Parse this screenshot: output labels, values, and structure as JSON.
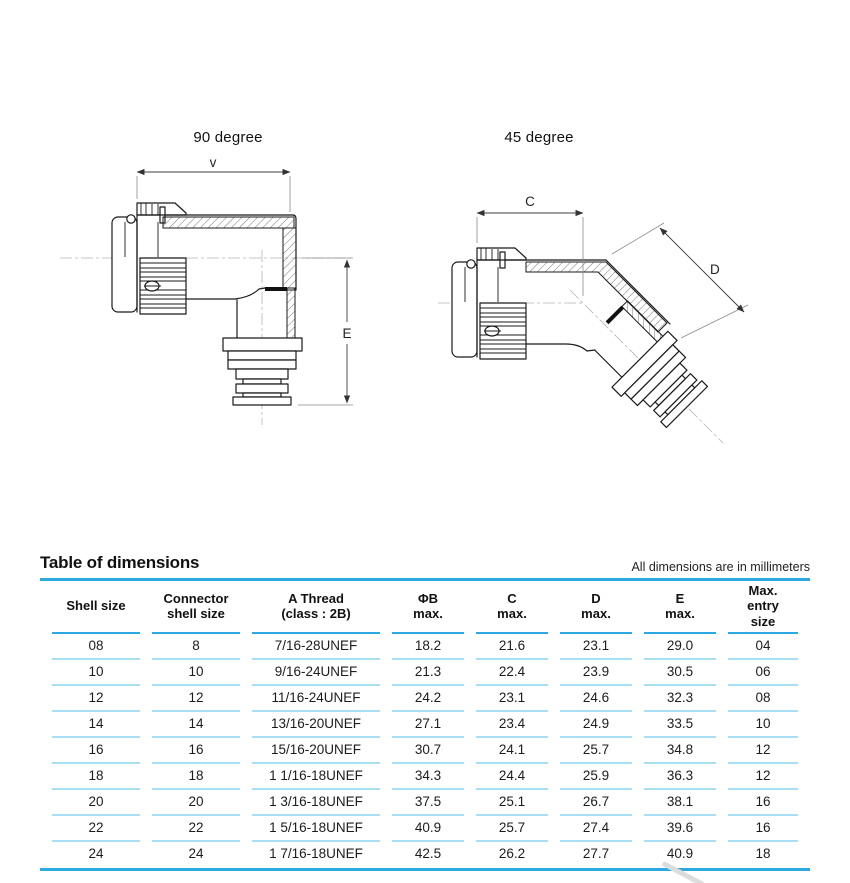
{
  "drawings": {
    "d90": {
      "title": "90 degree",
      "dim_top_label": "v",
      "dim_side_label": "E"
    },
    "d45": {
      "title": "45 degree",
      "dim_top_label": "C",
      "dim_diag_label": "D"
    }
  },
  "table": {
    "title": "Table of dimensions",
    "note": "All dimensions are in millimeters",
    "columns": [
      {
        "lines": [
          "Shell size"
        ]
      },
      {
        "lines": [
          "Connector",
          "shell size"
        ]
      },
      {
        "lines": [
          "A Thread",
          "(class : 2B)"
        ]
      },
      {
        "lines": [
          "ΦB",
          "max."
        ]
      },
      {
        "lines": [
          "C",
          "max."
        ]
      },
      {
        "lines": [
          "D",
          "max."
        ]
      },
      {
        "lines": [
          "E",
          "max."
        ]
      },
      {
        "lines": [
          "Max.",
          "entry",
          "size"
        ]
      }
    ],
    "rows": [
      [
        "08",
        "8",
        "7/16-28UNEF",
        "18.2",
        "21.6",
        "23.1",
        "29.0",
        "04"
      ],
      [
        "10",
        "10",
        "9/16-24UNEF",
        "21.3",
        "22.4",
        "23.9",
        "30.5",
        "06"
      ],
      [
        "12",
        "12",
        "11/16-24UNEF",
        "24.2",
        "23.1",
        "24.6",
        "32.3",
        "08"
      ],
      [
        "14",
        "14",
        "13/16-20UNEF",
        "27.1",
        "23.4",
        "24.9",
        "33.5",
        "10"
      ],
      [
        "16",
        "16",
        "15/16-20UNEF",
        "30.7",
        "24.1",
        "25.7",
        "34.8",
        "12"
      ],
      [
        "18",
        "18",
        "1 1/16-18UNEF",
        "34.3",
        "24.4",
        "25.9",
        "36.3",
        "12"
      ],
      [
        "20",
        "20",
        "1 3/16-18UNEF",
        "37.5",
        "25.1",
        "26.7",
        "38.1",
        "16"
      ],
      [
        "22",
        "22",
        "1 5/16-18UNEF",
        "40.9",
        "25.7",
        "27.4",
        "39.6",
        "16"
      ],
      [
        "24",
        "24",
        "1 7/16-18UNEF",
        "42.5",
        "26.2",
        "27.7",
        "40.9",
        "18"
      ]
    ]
  },
  "colors": {
    "accent": "#2BA9E0",
    "row_line": "#A9DFF4"
  }
}
